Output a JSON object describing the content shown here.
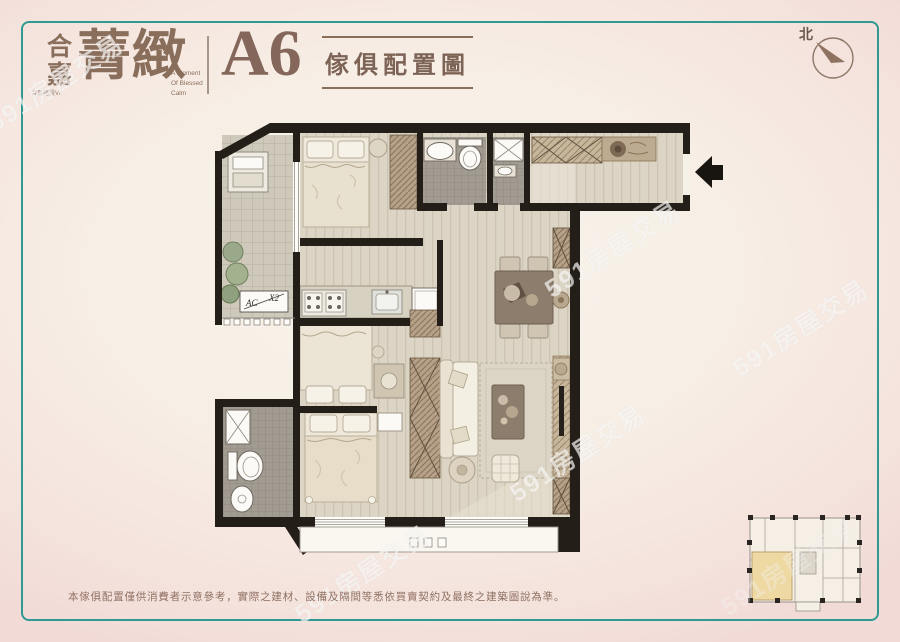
{
  "header": {
    "brand_name": "合嘉",
    "brand_small_text": "合嘉建設VI",
    "brand_series": "菁緻",
    "tagline_lines": [
      "A Moment",
      "Of Blessed",
      "Calm"
    ],
    "unit_label": "A6",
    "diagram_title": "傢俱配置圖"
  },
  "compass": {
    "north": "北"
  },
  "plan": {
    "ac_label": "AC",
    "ac_count": "X2"
  },
  "watermark": {
    "text": "591房屋交易"
  },
  "footer": {
    "disclaimer": "本傢俱配置僅供消費者示意參考，實際之建材、設備及隔間等悉依買賣契約及最終之建築圖說為準。"
  },
  "colors": {
    "accent_teal": "#2f9a93",
    "brand_brown": "#8a6e5c",
    "wall_black": "#241e18",
    "keyplan_highlight": "#eed9a3",
    "paper_pink": "#f2dbd7",
    "paper_cream": "#f8f3ea"
  }
}
